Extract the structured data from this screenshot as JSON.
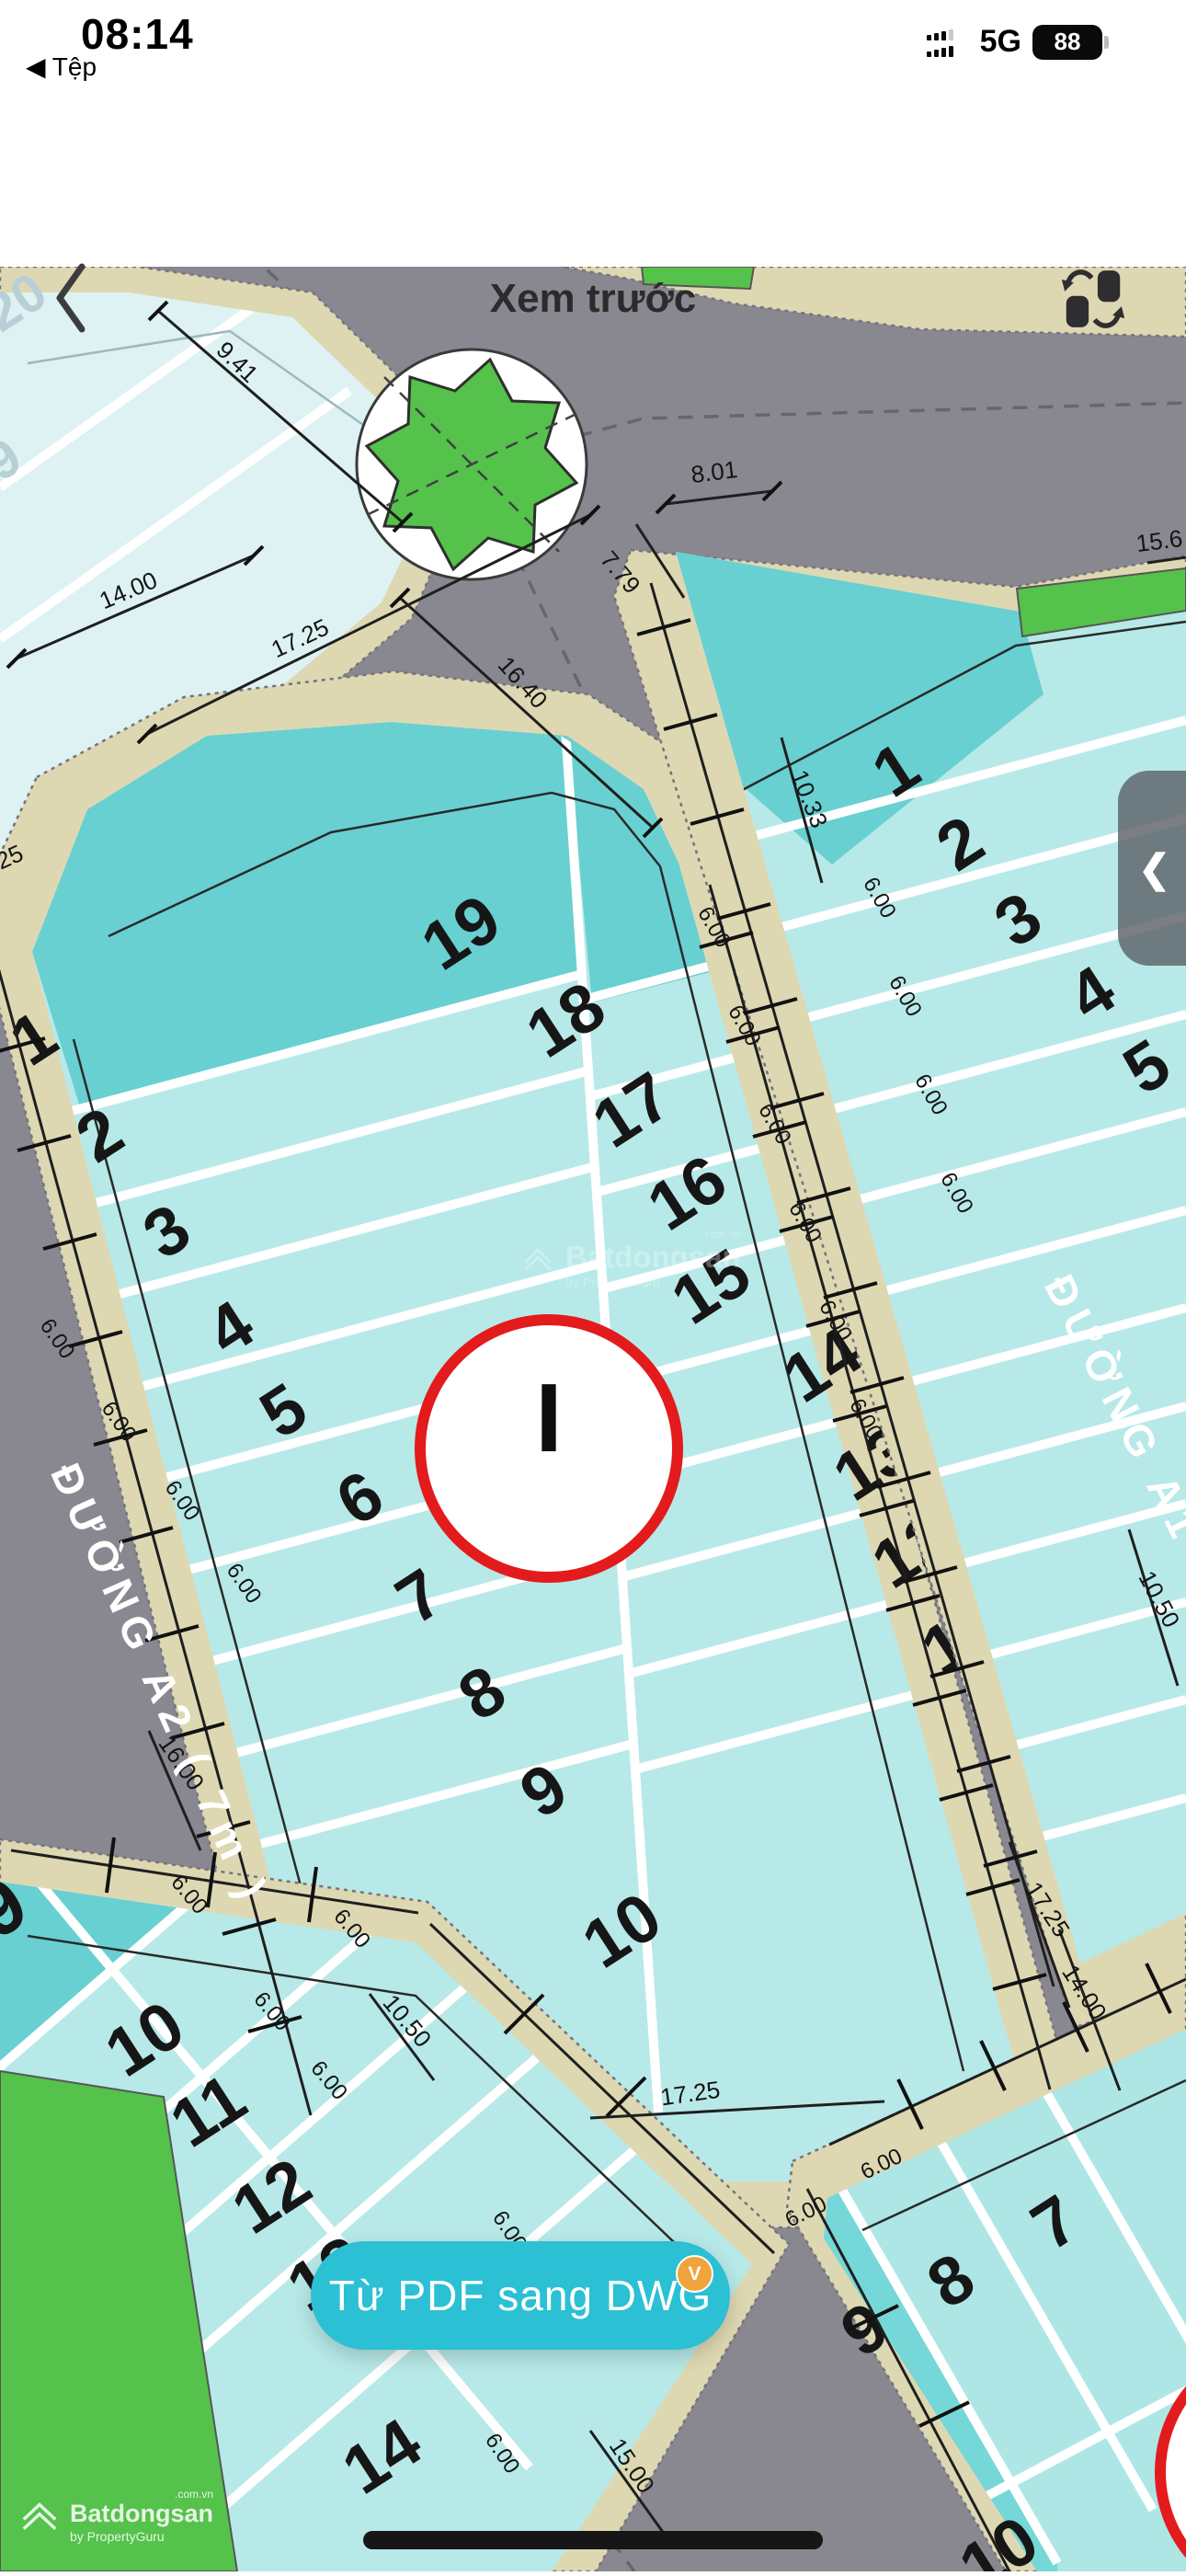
{
  "status_bar": {
    "time": "08:14",
    "back_to_app": "◀ Tệp",
    "network": "5G",
    "battery_percent": "88"
  },
  "nav_bar": {
    "title": "Xem trước"
  },
  "map": {
    "streets": {
      "a2": "ĐƯỜNG A2 ( 7m )",
      "a1": "ĐƯỜNG A1"
    },
    "marker": {
      "label": "I"
    },
    "lots": {
      "faded_block": [
        "20",
        "9"
      ],
      "main_left": [
        "1",
        "2",
        "3",
        "4",
        "5",
        "6",
        "7",
        "8",
        "9",
        "10"
      ],
      "main_right": [
        "19",
        "18",
        "17",
        "16",
        "15",
        "14",
        "13",
        "12",
        "11"
      ],
      "east_block": [
        "1",
        "2",
        "3",
        "4",
        "5"
      ],
      "south_west_block": [
        "9",
        "10",
        "11",
        "12",
        "13",
        "14"
      ],
      "south_east_block": [
        "7",
        "8",
        "9",
        "10"
      ]
    },
    "dimensions": {
      "w941": "9.41",
      "w1400": "14.00",
      "w1725": "17.25",
      "w1640": "16.40",
      "w779": "7.79",
      "w801": "8.01",
      "w156": "15.6",
      "w1033": "10.33",
      "w1050": "10.50",
      "w1500": "15.00",
      "w1600": "16.00",
      "w600": "6.00",
      "w25": "25"
    }
  },
  "watermarks": {
    "center": {
      "brand": "Batdongsan",
      "suffix": "com.vn",
      "byline": "by PropertyGuru"
    },
    "corner": {
      "brand": "Batdongsan",
      "suffix": ".com.vn",
      "byline": "by PropertyGuru"
    }
  },
  "cta": {
    "label": "Từ PDF sang DWG",
    "badge": "V"
  },
  "side_tab": {
    "chevron": "❮"
  },
  "colors": {
    "accent_teal": "#2BC0D4",
    "badge_orange": "#F0A43C",
    "road_gray": "#898891",
    "sidewalk_cream": "#DED8B2",
    "lot_teal_dark": "#68D0D1",
    "lot_teal_light": "#B7E9E8",
    "lot_pale": "#DEF2F3",
    "park_green": "#55C24B",
    "marker_red": "#E31B1C"
  }
}
